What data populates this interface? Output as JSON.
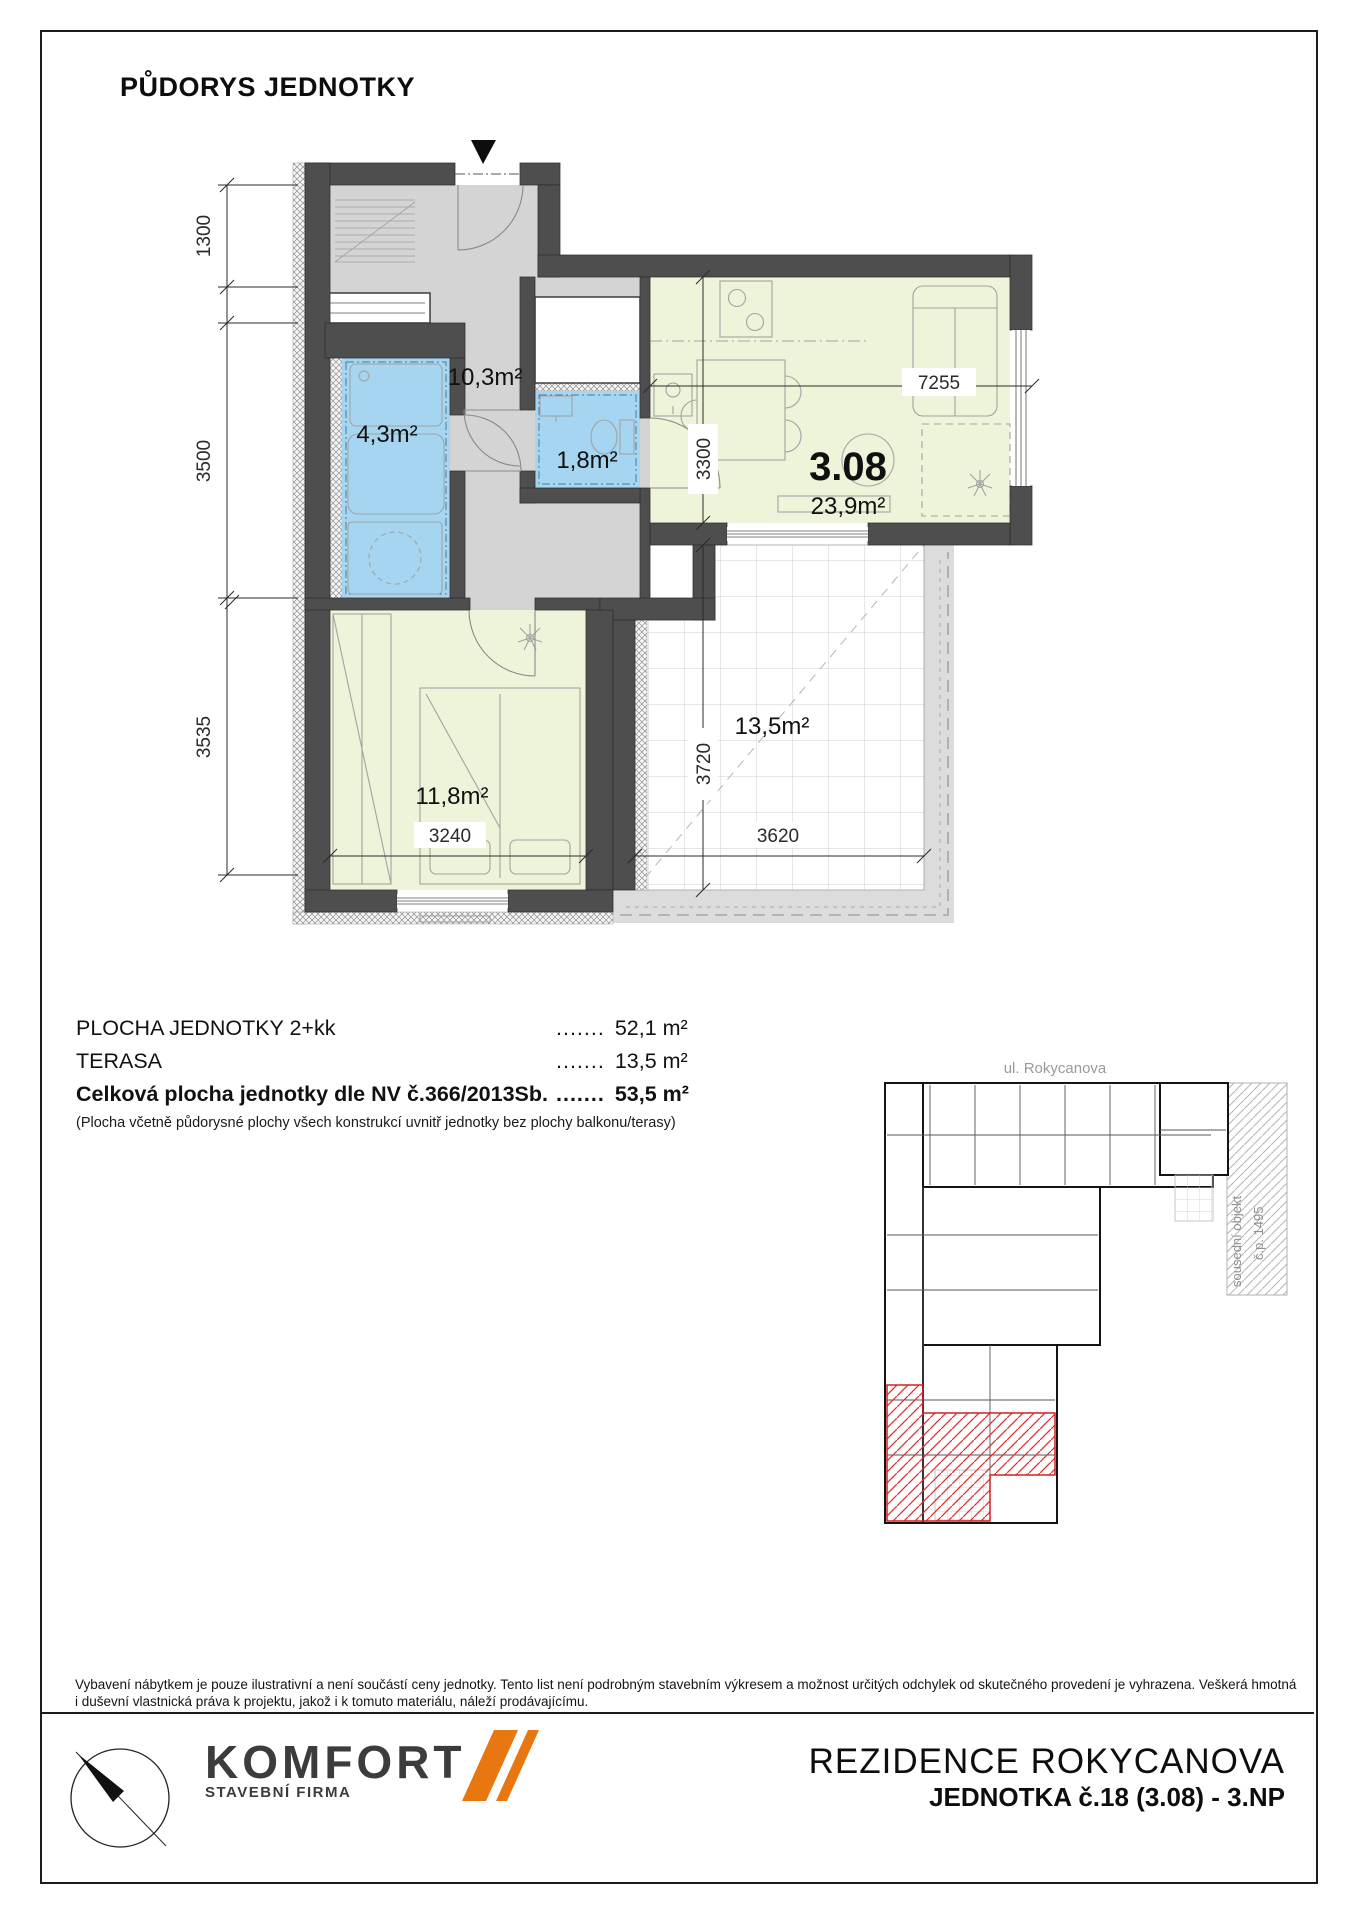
{
  "page": {
    "title": "PŮDORYS JEDNOTKY"
  },
  "plan": {
    "unit_number": "3.08",
    "rooms": {
      "hall": "10,3m²",
      "bath": "4,3m²",
      "wc": "1,8m²",
      "living_area": "23,9m²",
      "bedroom": "11,8m²",
      "terrace": "13,5m²"
    },
    "dimensions": {
      "left_top": "1300",
      "left_middle": "3500",
      "left_bottom": "3535",
      "living_width": "7255",
      "living_depth": "3300",
      "terrace_depth": "3720",
      "bedroom_width": "3240",
      "terrace_width": "3620"
    },
    "colors": {
      "wall": "#4E4E4E",
      "hall_floor": "#D4D4D4",
      "wet_room": "#A5D5F1",
      "room_green": "#EDF4D9",
      "highlight_red": "#E03030"
    }
  },
  "areas": {
    "rows": [
      {
        "label": "PLOCHA JEDNOTKY 2+kk",
        "dots": ".......",
        "value": "52,1 m²"
      },
      {
        "label": "TERASA",
        "dots": ".......",
        "value": "13,5 m²"
      },
      {
        "label": "Celková plocha jednotky dle NV č.366/2013Sb.",
        "dots": ".......",
        "value": "53,5 m²"
      }
    ],
    "note": "(Plocha včetně půdorysné plochy všech konstrukcí uvnitř jednotky bez plochy balkonu/terasy)"
  },
  "siteplan": {
    "street": "ul. Rokycanova",
    "neighbor_line1": "sousední objekt",
    "neighbor_line2": "č.p. 1495"
  },
  "disclaimer": {
    "line1": "Vybavení nábytkem je pouze ilustrativní a není součástí ceny jednotky. Tento list není podrobným stavebním výkresem a možnost určitých odchylek od skutečného provedení je vyhrazena. Veškerá hmotná",
    "line2": "i duševní vlastnická práva k projektu, jakož i k tomuto materiálu, náleží prodávajícímu."
  },
  "footer": {
    "logo_name": "KOMFORT",
    "logo_sub": "STAVEBNÍ FIRMA",
    "logo_accent": "#E8770F",
    "project": "REZIDENCE ROKYCANOVA",
    "unit": "JEDNOTKA č.18 (3.08) - 3.NP"
  }
}
